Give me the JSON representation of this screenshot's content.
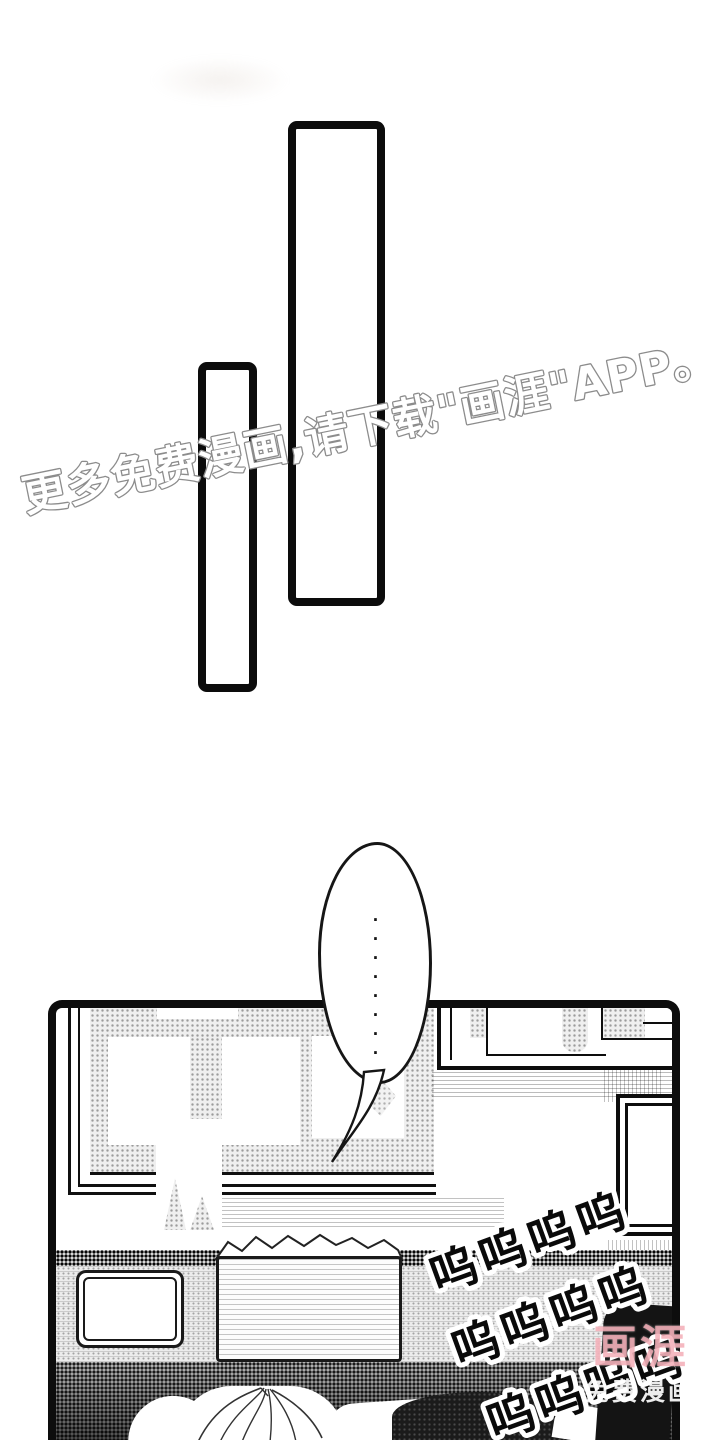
{
  "overlay_watermark": {
    "text": "更多免费漫画,请下载\"画涯\"APP。",
    "fill_color": "#ffffff",
    "outline_color": "#8c8c8c"
  },
  "speech_bubble": {
    "ellipsis_dots": "·········"
  },
  "sfx_cry": {
    "lines": [
      "呜呜呜呜",
      "呜呜呜呜",
      "呜呜呜呜"
    ],
    "fill_color": "#0a0a0a",
    "outline_color": "#ffffff"
  },
  "corner_logo": {
    "title": "画涯",
    "subtitle": "免费漫画",
    "title_color": "#f3aab3",
    "subtitle_color": "#ffffff"
  }
}
